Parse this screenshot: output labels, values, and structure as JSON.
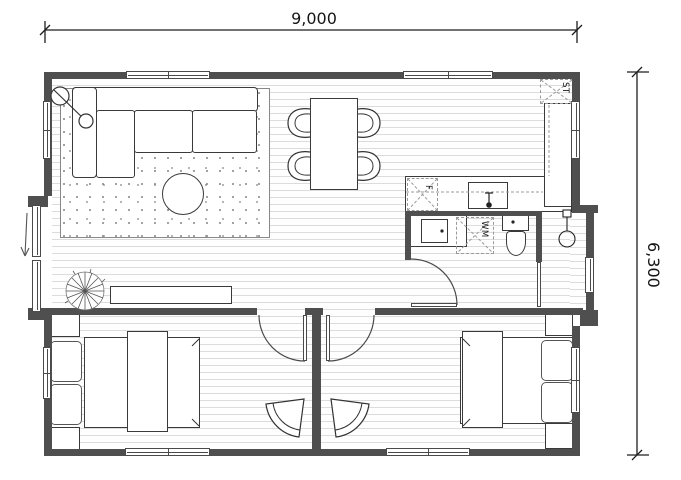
{
  "drawing": {
    "type": "floor-plan",
    "dimensions": {
      "width_label": "9,000",
      "height_label": "6,300"
    },
    "labels": {
      "storage": "ST",
      "fridge": "F",
      "washing_machine": "WM"
    }
  },
  "colors": {
    "wall": "#4f4f4f",
    "line": "#3a3a3a",
    "plank": "#dcdcdc",
    "dash": "#9a9a9a",
    "dot": "#909090"
  }
}
